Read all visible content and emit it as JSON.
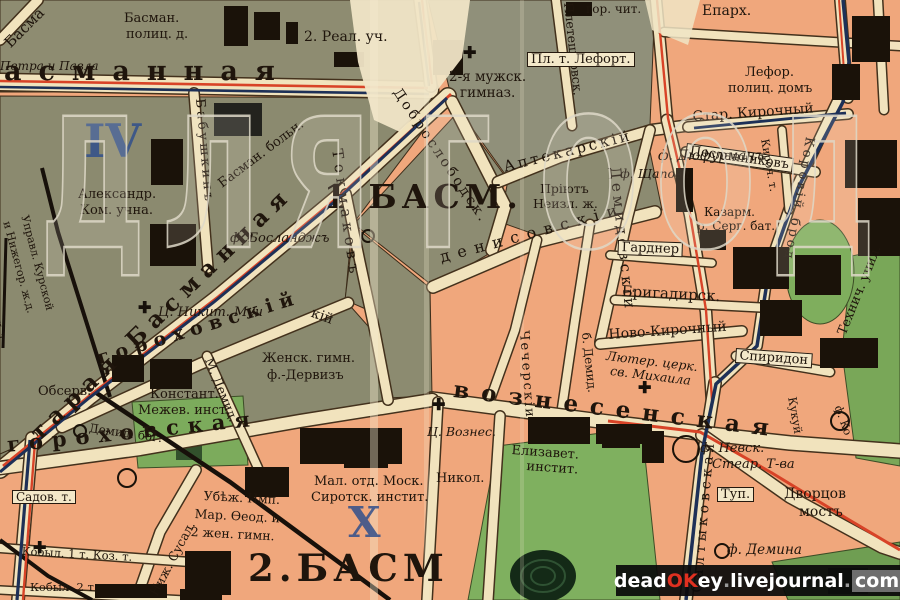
{
  "streets": [
    {
      "t": "асманная"
    },
    {
      "t": "тарая Басманная"
    },
    {
      "t": "гороховская"
    },
    {
      "t": "гороховскій"
    },
    {
      "t": "вознесенская"
    },
    {
      "t": "Токмаковъ"
    },
    {
      "t": "денисовскіи"
    },
    {
      "t": "Доброслободск."
    },
    {
      "t": "Аптекарскій"
    },
    {
      "t": "Демидовскіи"
    },
    {
      "t": "Чечерскіи"
    },
    {
      "t": "б. Демид."
    },
    {
      "t": "Бабушкинъ"
    },
    {
      "t": "Плетешковск."
    },
    {
      "t": "Салтыковская"
    },
    {
      "t": "Коровій брод"
    },
    {
      "t": "Стар. Кирочный"
    },
    {
      "t": "Ново-Кирочный"
    },
    {
      "t": "Бригадирск."
    },
    {
      "t": "Гарднер"
    },
    {
      "t": "Спиридон"
    },
    {
      "t": "Посланниковъ"
    },
    {
      "t": "Кироч. т."
    },
    {
      "t": "М. Демид."
    },
    {
      "t": "Ниж. Сусал."
    },
    {
      "t": "Кукуй"
    },
    {
      "t": "кій"
    },
    {
      "t": "Басма"
    },
    {
      "t": "енск. т."
    },
    {
      "t": "Туп."
    }
  ],
  "places": [
    {
      "t": "Басман."
    },
    {
      "t": "полиц. д."
    },
    {
      "t": "2. Реал. уч."
    },
    {
      "t": "Петра и Павла"
    },
    {
      "t": "Александр."
    },
    {
      "t": "Ком. учна."
    },
    {
      "t": "Управл. Курской"
    },
    {
      "t": "и Нижегор. ж.д."
    },
    {
      "t": "Басман. больн."
    },
    {
      "t": "2-я мужск."
    },
    {
      "t": "гимназ."
    },
    {
      "t": "гор. чит."
    },
    {
      "t": "Епарх."
    },
    {
      "t": "Пл. т. Лефорт."
    },
    {
      "t": "Лефор."
    },
    {
      "t": "полиц. домъ"
    },
    {
      "t": "ф. Дюфурманъ"
    },
    {
      "t": "ф. Щапова"
    },
    {
      "t": "Пріютъ"
    },
    {
      "t": "Неизл. ж."
    },
    {
      "t": "Казарм."
    },
    {
      "t": "р. Серг. бат."
    },
    {
      "t": "Лютер. церк."
    },
    {
      "t": "св. Михаила"
    },
    {
      "t": "Технич. учил."
    },
    {
      "t": "ф. Босланджъ"
    },
    {
      "t": "Ц. Никит. Муч"
    },
    {
      "t": "Женск. гимн."
    },
    {
      "t": "ф.-Дервизъ"
    },
    {
      "t": "Обсерв."
    },
    {
      "t": "Констант."
    },
    {
      "t": "Межев. инст."
    },
    {
      "t": "Демид. бог."
    },
    {
      "t": "Садов. т."
    },
    {
      "t": "Убѣж. Имп."
    },
    {
      "t": "Мар. Ѳеод. и"
    },
    {
      "t": "2 жен. гимн."
    },
    {
      "t": "Кобыл. 1 т. Коз. т."
    },
    {
      "t": "Кобыл. 2 т."
    },
    {
      "t": "Мал. отд. Моск."
    },
    {
      "t": "Сиротск. инстит."
    },
    {
      "t": "Никол."
    },
    {
      "t": "Ц. Вознес."
    },
    {
      "t": "Елизавет."
    },
    {
      "t": "инстит."
    },
    {
      "t": "ф. Невск."
    },
    {
      "t": "Стеар. Т-ва"
    },
    {
      "t": "Дворцов"
    },
    {
      "t": "мостъ"
    },
    {
      "t": "ф. Демина"
    },
    {
      "t": "ф. Ко"
    }
  ],
  "marks": {
    "iv": "IV",
    "x": "X",
    "basm1": "1 БАСМ.",
    "basm2": "2.БАСМ"
  },
  "watermark": {
    "letters": [
      {
        "t": "Д"
      },
      {
        "t": "Л"
      },
      {
        "t": "Я"
      },
      {
        "t": "Г"
      },
      {
        "t": "О"
      },
      {
        "t": "О"
      },
      {
        "t": "Д"
      }
    ]
  },
  "credit": {
    "p1": "dead",
    "p2": "OK",
    "p3": "ey",
    "d1": ".",
    "p4": "livejournal",
    "d2": ".",
    "p5": "com"
  },
  "icons": {
    "cross": "✚"
  },
  "colors": {
    "block_gray": "#8b8a6f",
    "block_salmon": "#f0a77c",
    "park_green": "#7fb05f",
    "street_cream": "#f1e3bd",
    "line_red": "#d84327",
    "line_navy": "#1d3057",
    "ink_blue": "#31508c",
    "credit_accent": "#e03020"
  }
}
